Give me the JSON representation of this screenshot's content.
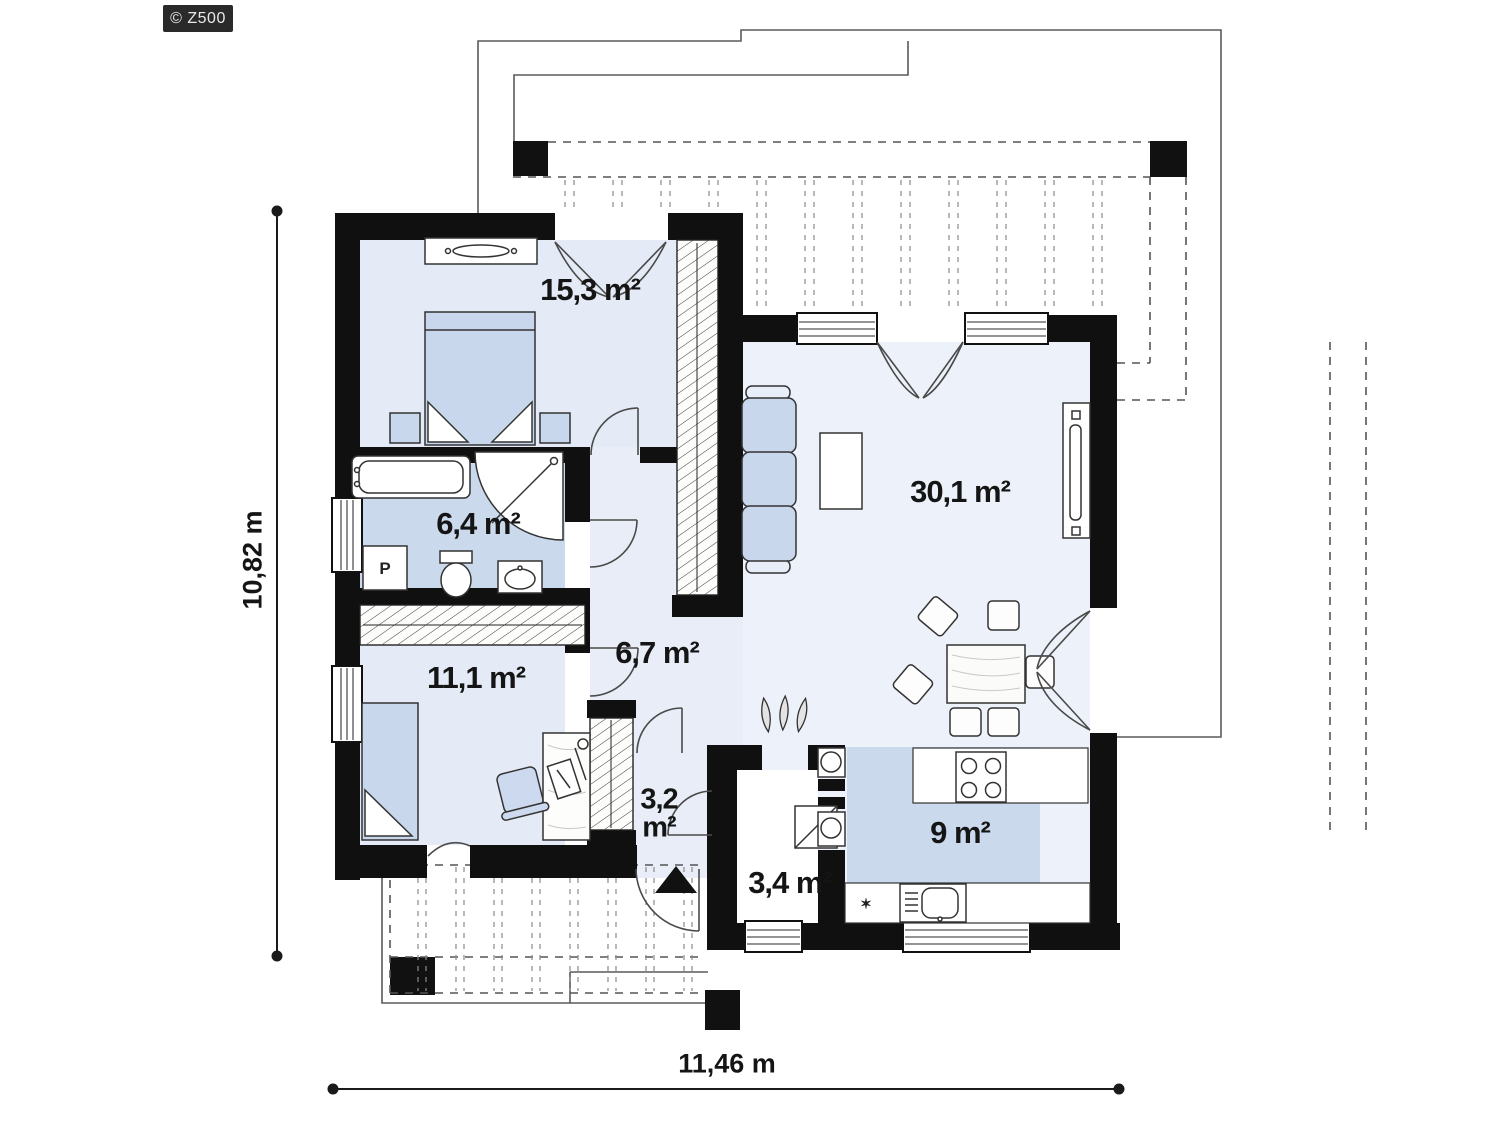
{
  "meta": {
    "type": "floor_plan",
    "colors": {
      "wall": "#101010",
      "room_light": "#e4ebf6",
      "room_lighter": "#edf1f9",
      "room_accent": "#cbd9ec",
      "hall": "#e8edf7",
      "logo_bg": "#2a2a2a"
    }
  },
  "logo": {
    "text": "© Z500"
  },
  "dimensions": {
    "height_label": "10,82 m",
    "width_label": "11,46 m"
  },
  "rooms": {
    "bedroom1": {
      "name": "bedroom",
      "area": "15,3 m²"
    },
    "living": {
      "name": "living-room",
      "area": "30,1 m²"
    },
    "bathroom": {
      "name": "bathroom",
      "area": "6,4 m²"
    },
    "bedroom2": {
      "name": "second-bedroom",
      "area": "11,1 m²"
    },
    "hall": {
      "name": "hall",
      "area": "6,7 m²"
    },
    "vestibule": {
      "name": "vestibule",
      "area_line1": "3,2",
      "area_line2": "m²"
    },
    "utility": {
      "name": "utility-room",
      "area": "3,4 m²"
    },
    "kitchen": {
      "name": "kitchen",
      "area": "9 m²"
    }
  },
  "markers": {
    "washing_machine": "P",
    "kitchen_asterisk": "✶"
  }
}
